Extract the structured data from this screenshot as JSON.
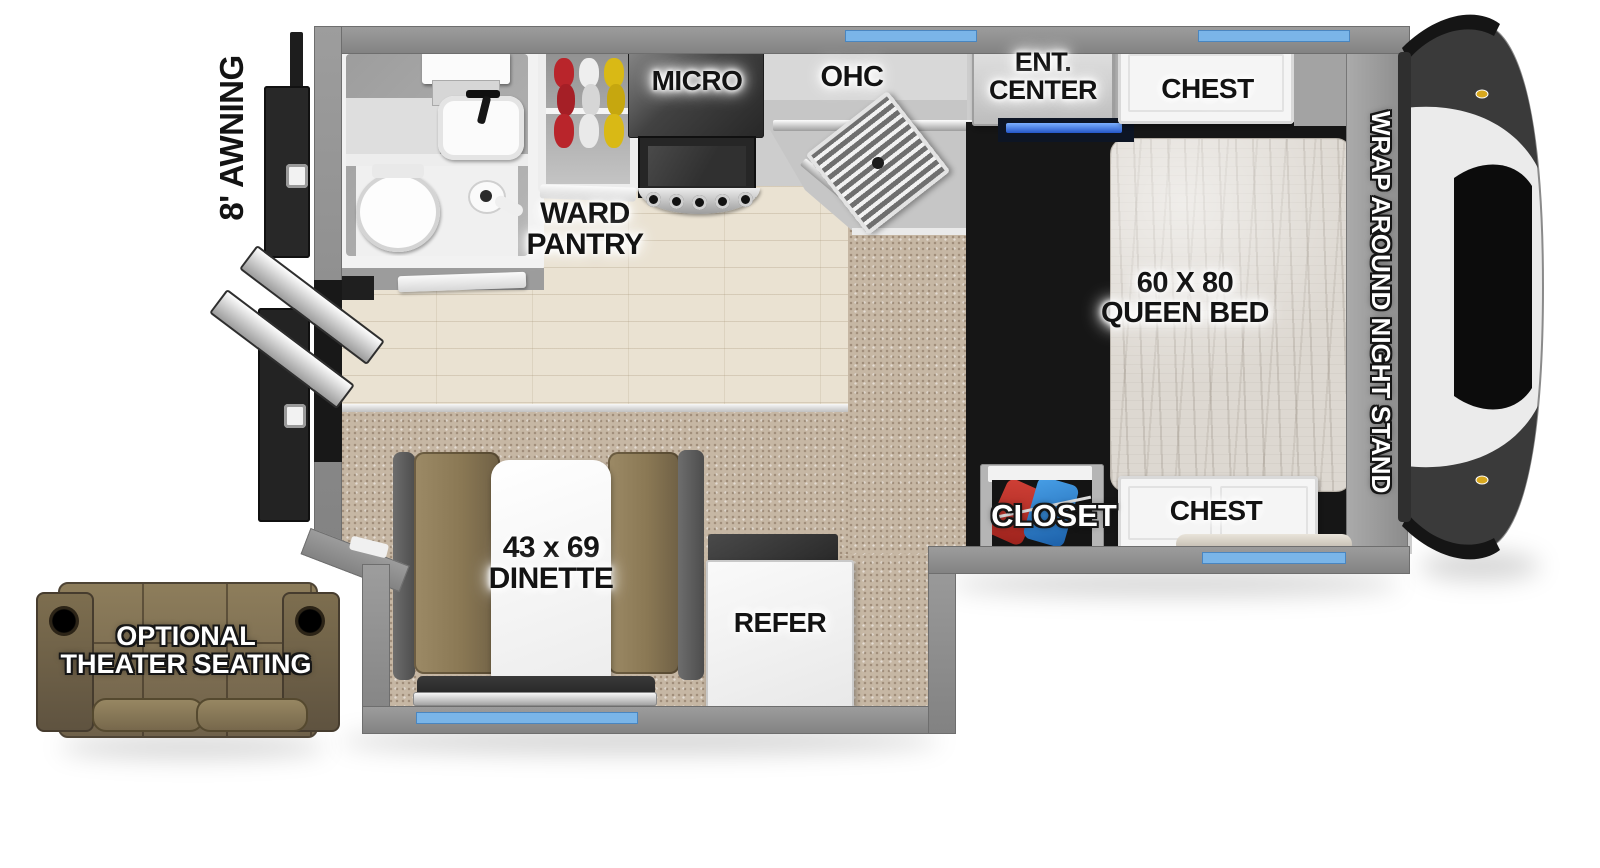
{
  "floorplan": {
    "exterior": {
      "awning_label": "8' AWNING",
      "theater_seating": {
        "line1": "OPTIONAL",
        "line2": "THEATER SEATING"
      }
    },
    "bathroom": {},
    "kitchen": {
      "micro_label": "MICRO",
      "ohc_label": "OHC",
      "ward_pantry": {
        "line1": "WARD",
        "line2": "PANTRY"
      }
    },
    "bedroom": {
      "ent_center": {
        "line1": "ENT.",
        "line2": "CENTER"
      },
      "chest_top_label": "CHEST",
      "queen_bed": {
        "line1": "60 X 80",
        "line2": "QUEEN BED"
      },
      "night_stand_label": "WRAP AROUND NIGHT STAND",
      "closet_label": "CLOSET",
      "chest_bottom_label": "CHEST"
    },
    "dinette": {
      "line1": "43 x 69",
      "line2": "DINETTE"
    },
    "refer_label": "REFER",
    "colors": {
      "window_blue": "#7ab5e8",
      "led_blue": "#2e6fd9",
      "wall_gray": "#8f8f8f",
      "carpet_tan": "#c6b7a4",
      "wood_floor": "#eae2d2",
      "mattress": "#dcd7d0",
      "dinette_cushion_brown": "#8a7854",
      "sofa_brown": "#7b6c4f",
      "hanger_red": "#b9252b",
      "hanger_white": "#e9e9e9",
      "hanger_yellow": "#d9b915",
      "closet_clothes_red": "#c23028",
      "closet_clothes_blue": "#2a7fd0"
    }
  }
}
